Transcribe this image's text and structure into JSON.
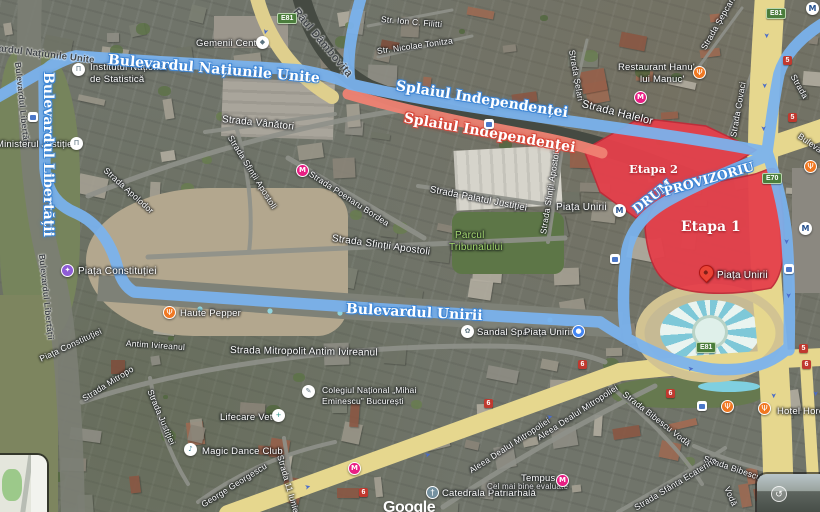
{
  "map": {
    "attribution": "Google",
    "colors": {
      "route_blue": "#7ab3ef",
      "route_red": "#ef8273",
      "stage_fill": "#e5404b",
      "stage_border": "#bf2b38",
      "road_yellow": "#e6d78e",
      "water": "#454a42",
      "park_label_green": "#a5d86f"
    },
    "routes": {
      "natiunile": "Bulevardul Națiunile Unite",
      "splaiul": "Splaiul Independenței",
      "unirii": "Bulevardul Unirii",
      "libertatii": "Bulevardul Libertății"
    },
    "stages": {
      "etapa1": "Etapa 1",
      "etapa2": "Etapa 2",
      "drum1": "DRUM",
      "drum2": "PROVIZORIU"
    },
    "streets": {
      "raul": "Râul Dâmbovița",
      "natiunile_road": "Bulevardul Națiunile Unite",
      "libertatii_road": "Bulevardul Libertății",
      "filitti": "Str. Ion C. Filitti",
      "tonitza": "Str. Nicolae Tonitza",
      "selari": "Strada Șelari",
      "sepcari": "Strada Șepcari",
      "covaci": "Strada Covaci",
      "halelor": "Strada Halelor",
      "vanatori": "Strada Vânători",
      "apolodor": "Strada Apolodor",
      "poenaru": "Strada Poenaru Bordea",
      "palatul": "Strada Palatul Justiției",
      "apostoli": "Strada Sfinții Apostoli",
      "parcul1": "Parcul",
      "parcul2": "Tribunalului",
      "piata_constitutiei": "Piața Constituției",
      "mitropolit": "Strada Mitropolit Antim Ivireanul",
      "mitropolit_frag": "Antim Ivireanul",
      "mitropolit_frag2": "Strada Mitropo",
      "justitiei": "Strada Justiției",
      "iunie": "Strada 11 Iunie",
      "georgescu": "George Georgescu",
      "aleea": "Aleea Dealul Mitropoliei",
      "bibescu": "Strada Bibescu Vodă",
      "bibescu_frag": "Strada Bibescu",
      "voda_frag": "Vodă",
      "ecaterina": "Strada Sfânta Ecaterina",
      "strada_frag": "Strada",
      "bulevardul_frag": "Bulevardul"
    },
    "poi": {
      "gemenii": "Gemenii Center",
      "institutul1": "Institutul Național",
      "institutul2": "de Statistică",
      "ministerul": "Ministerul Justiției",
      "hanu1": "Restaurant Hanu'",
      "hanu2": "lui Manuc'",
      "unirii_station": "Piața Unirii",
      "unirii_pin": "Piața Unirii",
      "sandal": "Sandal Spa",
      "sandal2": "Piața Unirii",
      "haute": "Haute Pepper",
      "lifecare": "Lifecare Vet",
      "magic": "Magic Dance Club",
      "colegiul1": "Colegiul Național „Mihai",
      "colegiul2": "Eminescu” București",
      "catedrala": "Catedrala Patriarhală",
      "tempus": "Tempus",
      "tempus_sub": "Cel mai bine evaluate",
      "hotel": "Hotel Horoscop"
    },
    "badges": {
      "e81": "E81",
      "e70": "E70",
      "n5": "5",
      "n6": "6"
    },
    "icons": {
      "metro": "M",
      "restaurant": "Ψ",
      "church": "†",
      "school": "✎",
      "attraction": "✦",
      "spa": "✿",
      "bank": "Π",
      "note": "♪",
      "vet": "+",
      "shop": "◆",
      "info": "●",
      "street_view_arrow": "↺",
      "arrow": "➤"
    }
  }
}
